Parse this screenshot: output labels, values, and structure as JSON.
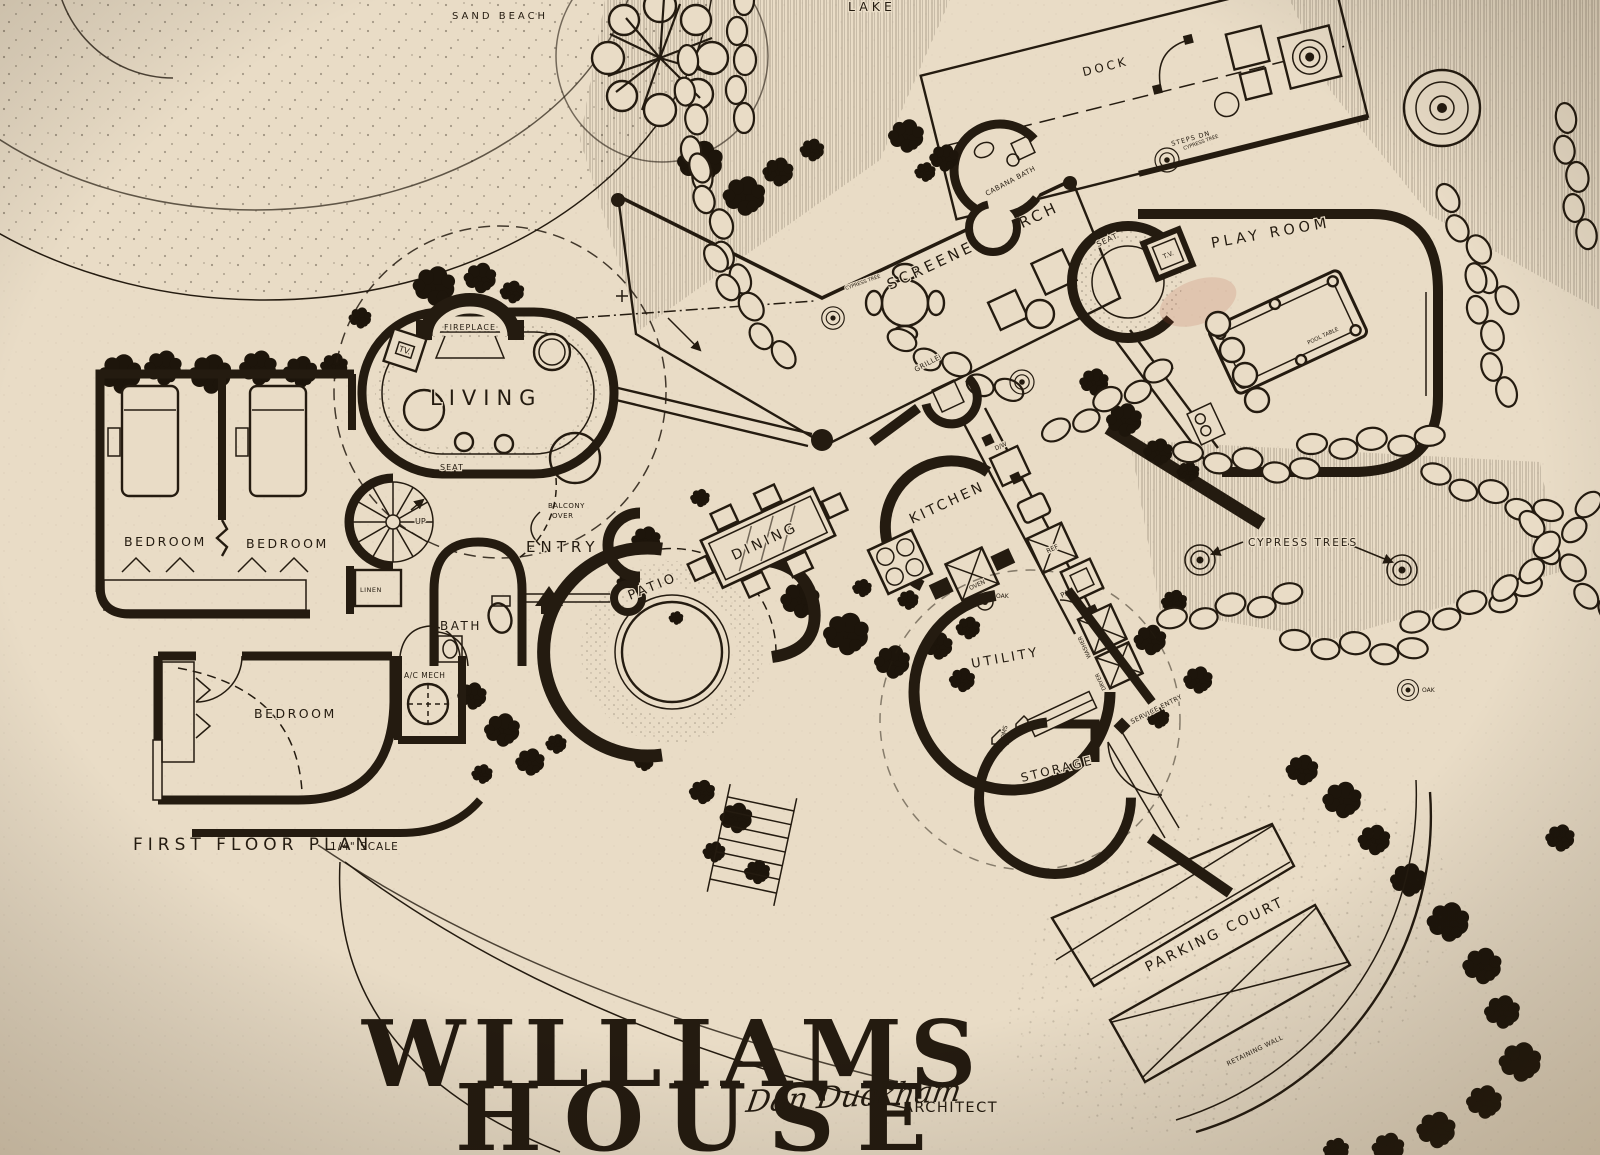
{
  "title": {
    "line1": "WILLIAMS",
    "line2": "HOUSE",
    "signature": "Dan Duckham",
    "architect": "ARCHITECT"
  },
  "caption": {
    "plan": "FIRST FLOOR PLAN",
    "scale": "1/4\" SCALE"
  },
  "site": {
    "lake": "LAKE",
    "sand_beach": "SAND BEACH",
    "dock": "DOCK",
    "screened_porch": "SCREENED PORCH",
    "parking_court": "PARKING COURT",
    "retaining_wall": "RETAINING WALL",
    "cypress_trees": "CYPRESS TREES",
    "cypress_tree": "CYPRESS TREE",
    "steps": "STEPS DN",
    "oak": "OAK"
  },
  "rooms": {
    "living": "LIVING",
    "bedroom": "BEDROOM",
    "bath": "BATH",
    "entry": "ENTRY",
    "patio": "PATIO",
    "dining": "DINING",
    "kitchen": "KITCHEN",
    "utility": "UTILITY",
    "storage": "STORAGE",
    "play_room": "PLAY ROOM",
    "bar": "BAR",
    "cabana_bath": "CABANA BATH",
    "ac_mech": "A/C MECH"
  },
  "fixtures": {
    "fireplace": "FIREPLACE",
    "tv": "TV.",
    "tv_play": "T.V.",
    "seat": "SEAT",
    "up": "UP",
    "linen": "LINEN",
    "balcony": "BALCONY",
    "over": "OVER",
    "grille": "GRILLE",
    "dishwasher": "D/W",
    "refrigerator": "REF",
    "oven": "OVEN",
    "pantry": "PANTRY",
    "washer": "WASHER",
    "dryer": "DRYER",
    "brooms": "BROOMS",
    "service_entry": "SERVICE ENTRY",
    "pool_table": "POOL TABLE"
  },
  "colors": {
    "paper": "#e9dcc6",
    "ink": "#241b10",
    "smudge": "#b5503a"
  }
}
